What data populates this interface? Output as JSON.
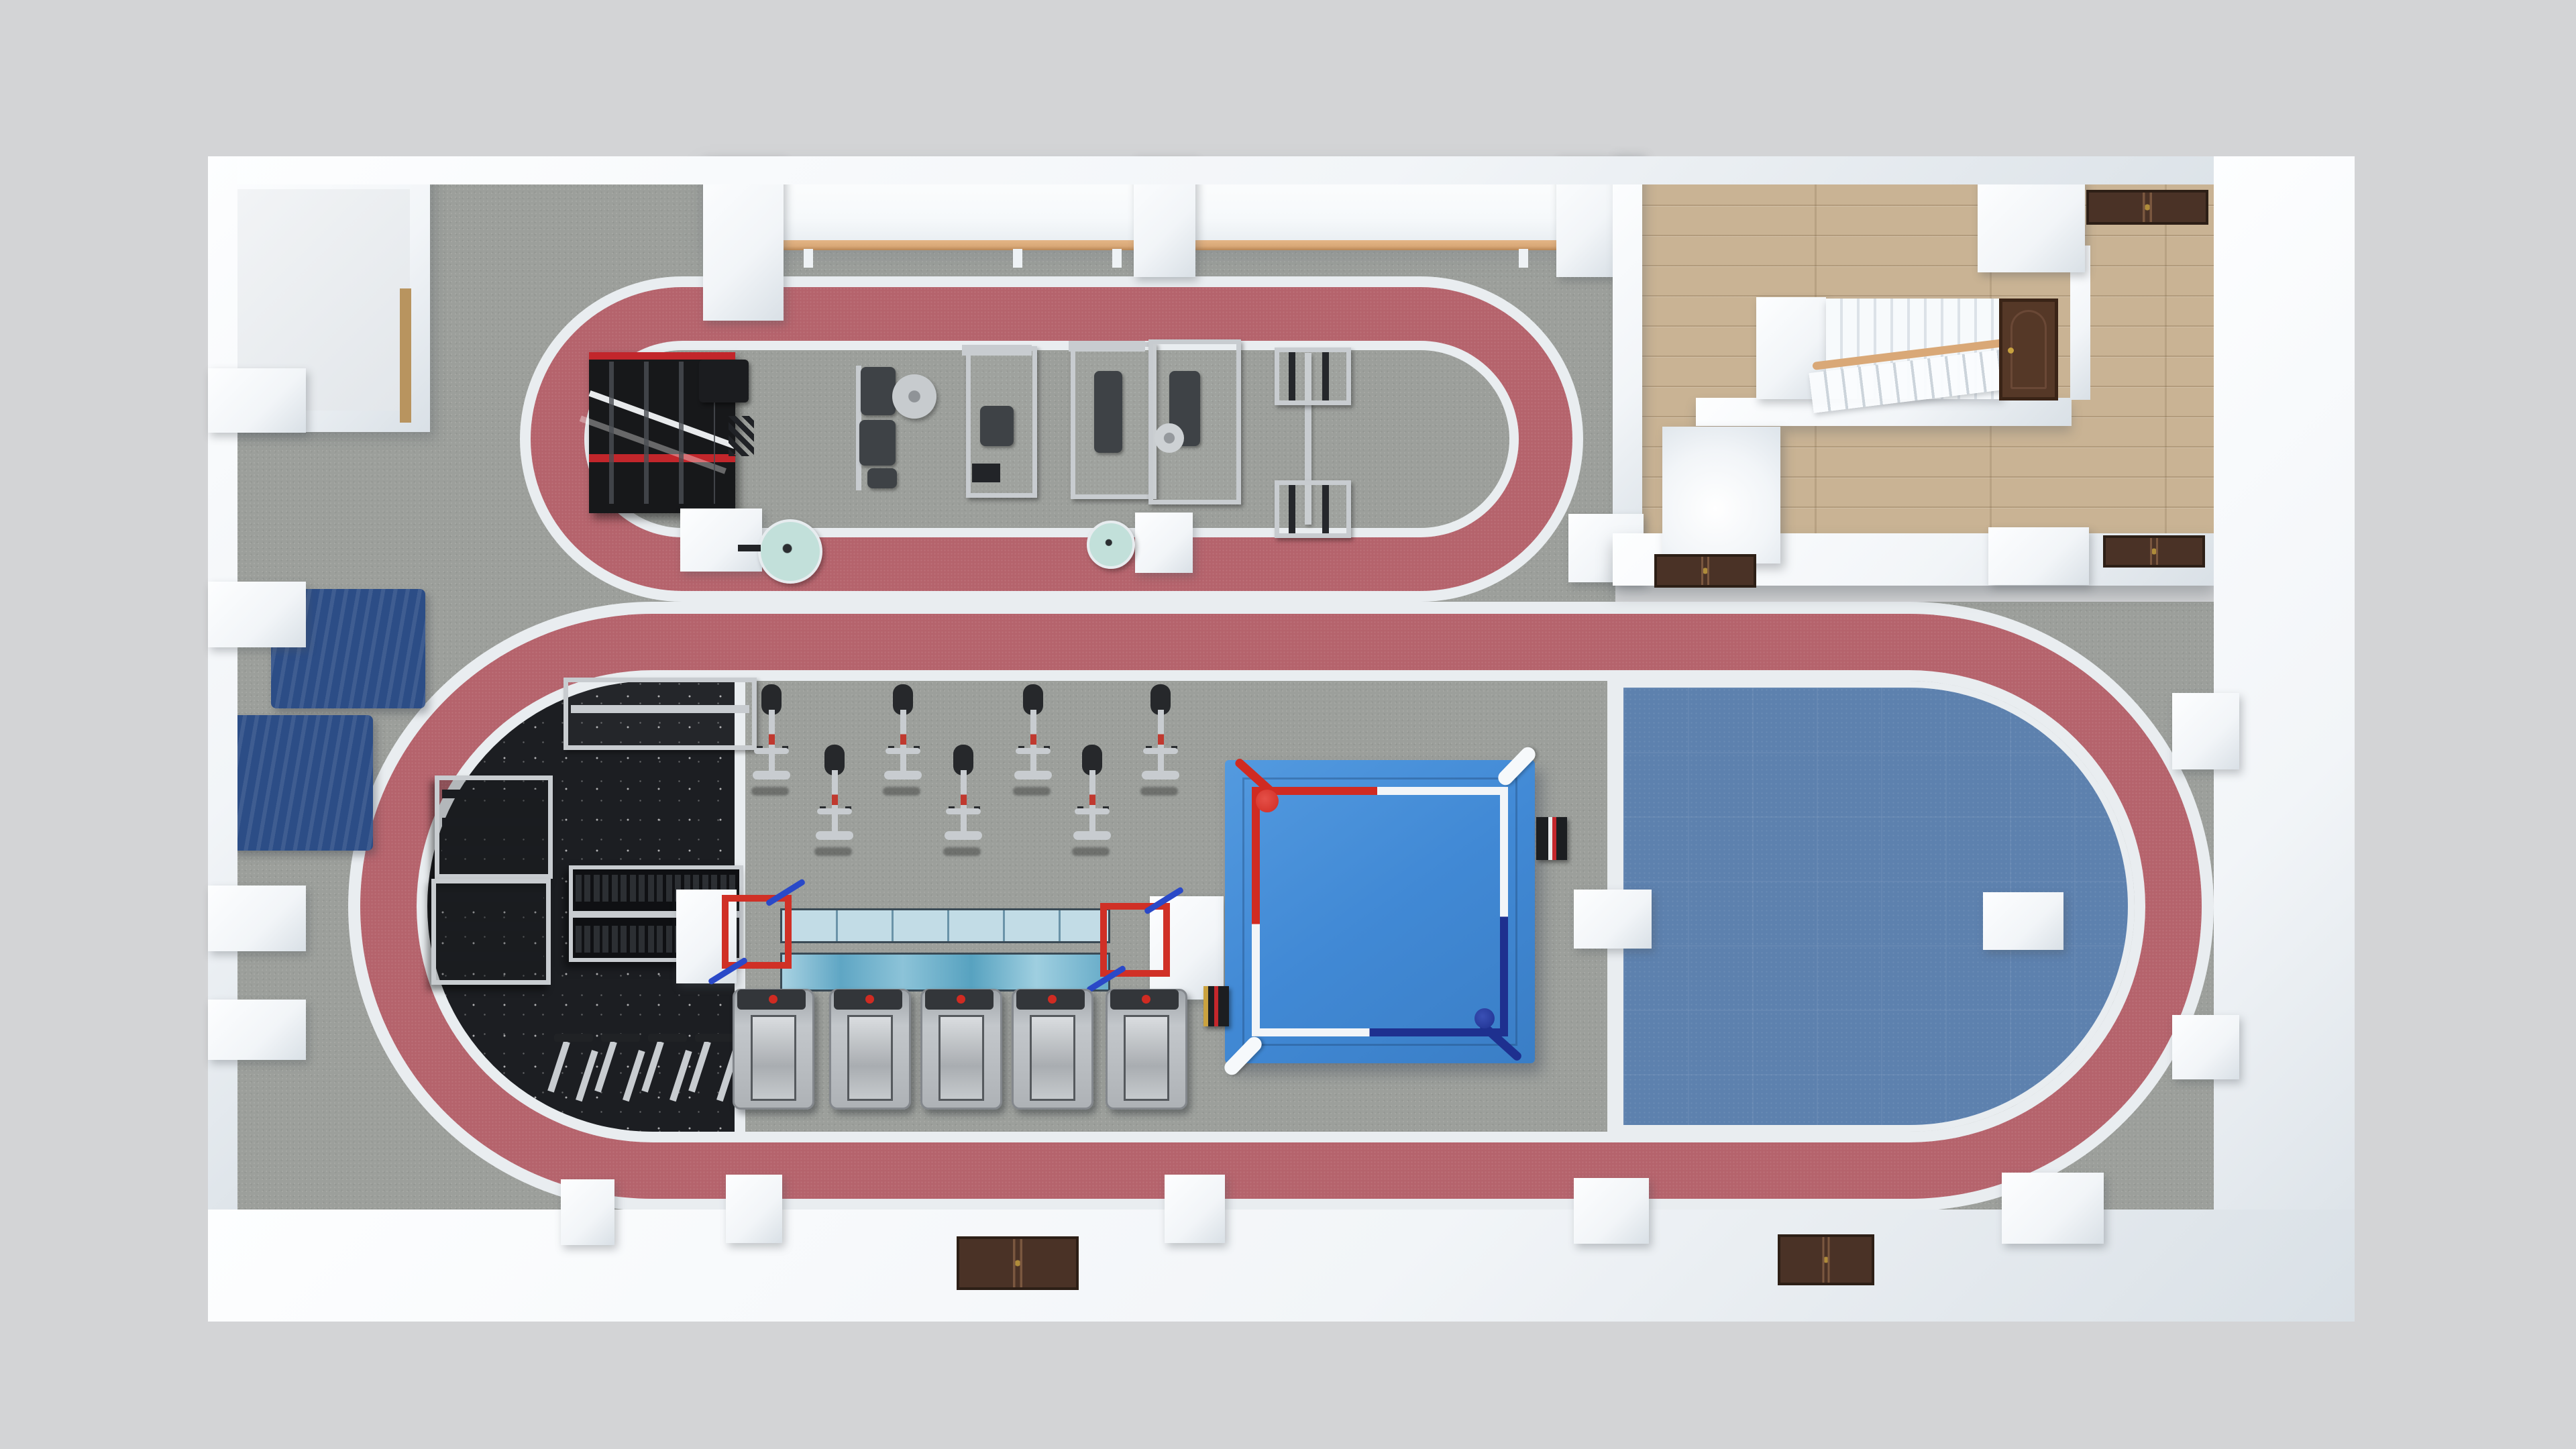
{
  "scene": {
    "description": "Top-down 3D architectural render of a fitness gym floor plan with two rose-red indoor jogging tracks, strength and cardio equipment, a boxing ring, a blue mat zone and a wood-floored entrance lobby with staircase",
    "view": "top-down",
    "visible_text": ""
  },
  "colors": {
    "background": "#d3d4d6",
    "wall": "#f2f5f8",
    "wall_bright": "#fdfeff",
    "wall_shade": "#d9e0e6",
    "floor_gray": "#9c9f9b",
    "rubber_black": "#1c1e22",
    "track_red": "#b5636c",
    "line_white": "#e9edf0",
    "mat_blue": "#5d81ae",
    "crash_navy": "#2c4d86",
    "wood": "#c9b394",
    "ring_blue": "#4189d5",
    "rope_red": "#d02b22",
    "rope_navy": "#1e308f",
    "runway_tile": "#c2dce6",
    "runway_turf": "#7ab8d0",
    "gate_red": "#d03026",
    "gate_blue": "#2a49c8",
    "silver": "#c8ccd0",
    "dark_pad": "#3e4246",
    "door_wood": "#4a3226",
    "barre_wood": "#d9a877",
    "fan_teal": "#c2e0da",
    "gold": "#c8a23f"
  },
  "zones": [
    {
      "name": "upper-machine-zone",
      "floor": "gray",
      "features": [
        "ballet-barre",
        "power-rack",
        "strength-machines",
        "cable-station",
        "fans"
      ]
    },
    {
      "name": "upper-jogging-track",
      "floor": "track_red"
    },
    {
      "name": "entrance-lobby",
      "floor": "wood",
      "features": [
        "staircase",
        "reception-counter",
        "door-mats"
      ]
    },
    {
      "name": "free-weight-zone",
      "floor": "rubber_black",
      "features": [
        "storage-racks",
        "dumbbell-rack",
        "barbell-stands"
      ]
    },
    {
      "name": "cardio-zone",
      "floor": "gray",
      "features": [
        "spin-bikes",
        "sled-runway",
        "treadmills"
      ]
    },
    {
      "name": "boxing-ring-zone",
      "floor": "gray"
    },
    {
      "name": "blue-mat-zone",
      "floor": "mat_blue"
    },
    {
      "name": "lower-jogging-track",
      "floor": "track_red"
    }
  ],
  "equipment": {
    "power_rack": 1,
    "strength_machines": 4,
    "cable_station": 1,
    "adjustable_bench": 1,
    "pedestal_fans": 2,
    "ballet_barre_sections": 2,
    "storage_racks": 3,
    "dumbbell_rack": 1,
    "barbell_stands": 4,
    "spin_bikes": 7,
    "treadmills": 5,
    "sled_runway_lanes": 2,
    "runway_gates": 2,
    "boxing_ring": 1,
    "ring_side_steps": 2,
    "crash_mats": 2,
    "staircase": 1,
    "reception_counter": 1,
    "door_mats": 5,
    "interior_columns": 4
  }
}
